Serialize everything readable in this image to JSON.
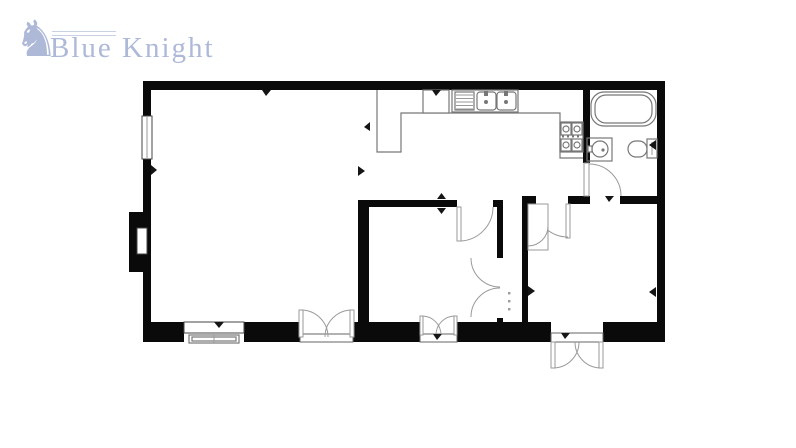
{
  "brand": {
    "name": "Blue Knight",
    "icon": "knight-on-horseback-icon",
    "text_color": "#aeb9d8",
    "lance_line_color": "#c9d2e4"
  },
  "floorplan": {
    "background": "#ffffff",
    "wall_color": "#0a0a0a",
    "fixture_stroke": "#777777",
    "door_arc_color": "#9a9a9a",
    "marker_color": "#151515",
    "symbols": [
      "window",
      "bay-recess",
      "kitchen-counter",
      "refrigerator",
      "double-sink-with-drainer",
      "four-burner-hob",
      "bathtub",
      "wash-basin",
      "toilet",
      "single-door",
      "double-doors",
      "french-doors",
      "bifold-closet-doors",
      "storage-cupboard",
      "wall-tick-marker",
      "shelf-dots"
    ]
  }
}
